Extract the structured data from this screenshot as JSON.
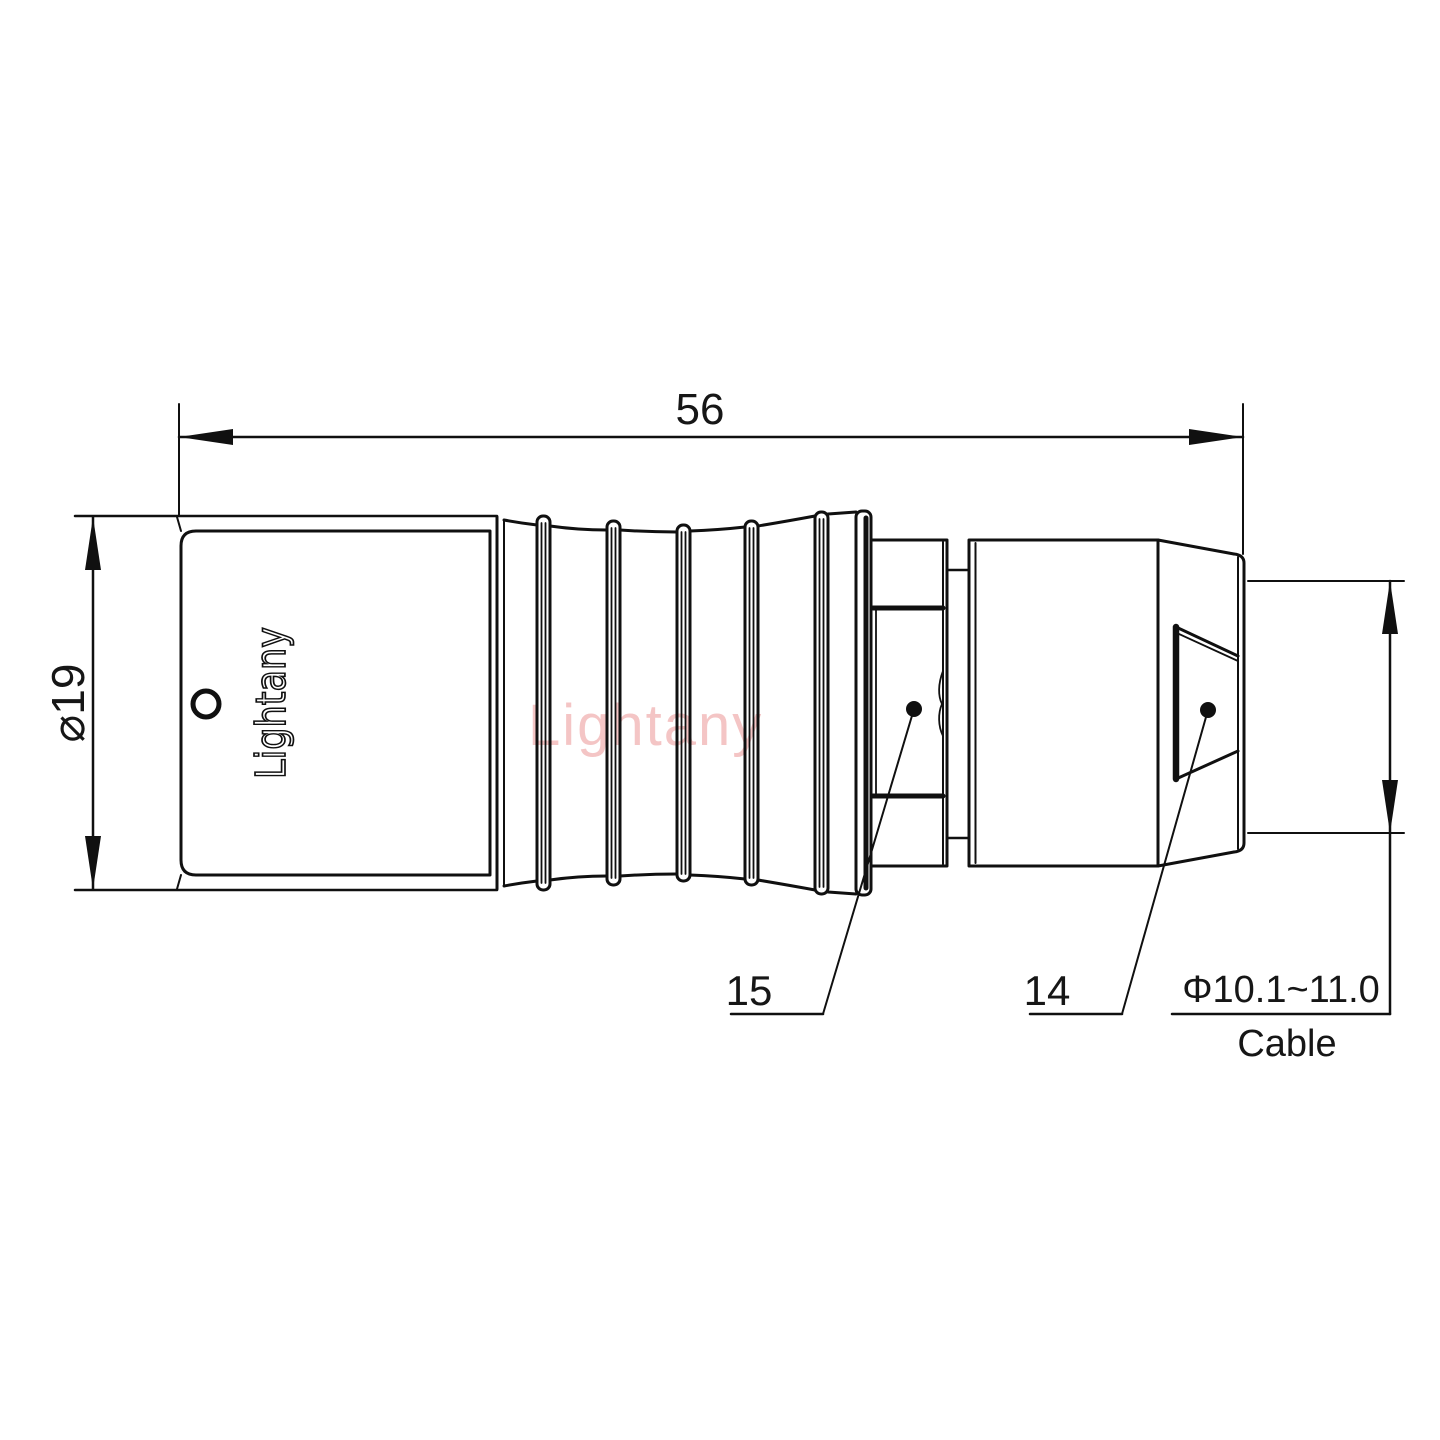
{
  "meta": {
    "background_color": "#ffffff",
    "line_color": "#101010",
    "watermark_color": "#e87f7f"
  },
  "annotations": {
    "length_dim": "56",
    "diameter_dim": "⌀19",
    "label_15": "15",
    "label_14": "14",
    "cable_dim": "Φ10.1~11.0",
    "cable_label": "Cable"
  },
  "branding": {
    "engraving": "Lightany",
    "watermark": "Lightany"
  }
}
